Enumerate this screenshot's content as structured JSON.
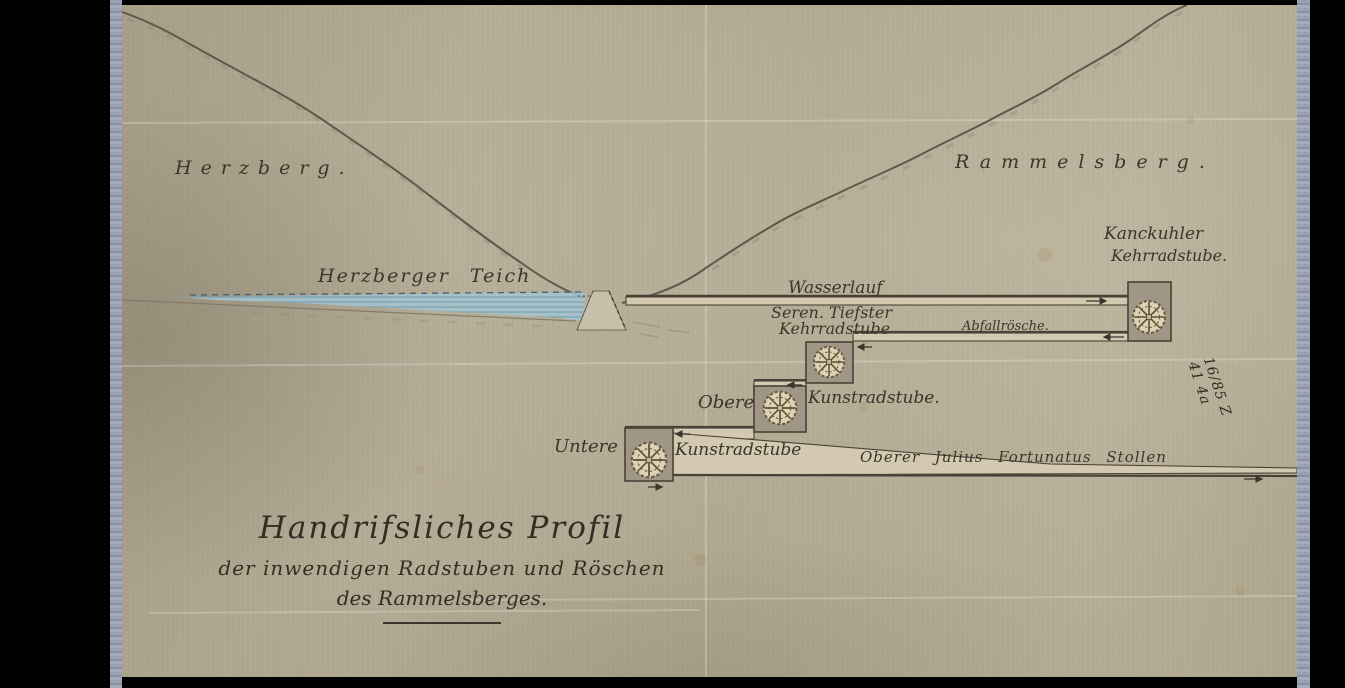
{
  "document": {
    "kind": "scanned historical mining profile drawing",
    "title": {
      "line1": "Handrifsliches Profil",
      "line2": "der inwendigen Radstuben und Röschen",
      "line3": "des Rammelsberges."
    },
    "terrain": {
      "left_mountain": "Herzberg.",
      "right_mountain": "Rammelsberg.",
      "pond": "Herzberger Teich"
    },
    "waterworks": {
      "water_course": "Wasserlauf",
      "kanekuhler_wheelhouse_line1": "Kanckuhler",
      "kanekuhler_wheelhouse_line2": "Kehrradstube.",
      "seren_tiefster_line1": "Seren. Tiefster",
      "seren_tiefster_line2": "Kehrradstube",
      "waste_channel": "Abfallrösche.",
      "upper_wheelhouse_prefix": "Obere",
      "upper_wheelhouse": "Kunstradstube.",
      "lower_wheelhouse_prefix": "Untere",
      "lower_wheelhouse": "Kunstradstube",
      "adit": "Oberer Julius Fortunatus Stollen"
    },
    "annotations": {
      "archive_note": "16/85 Z 41 4a"
    },
    "colors": {
      "paper": "#b3aa93",
      "ink": "#3b352c",
      "water": "#a3c4d1",
      "wall_fill": "#a09686",
      "channel_fill": "#d2c9b0",
      "mount_strip": "#99a1b4",
      "border": "#000000"
    }
  }
}
